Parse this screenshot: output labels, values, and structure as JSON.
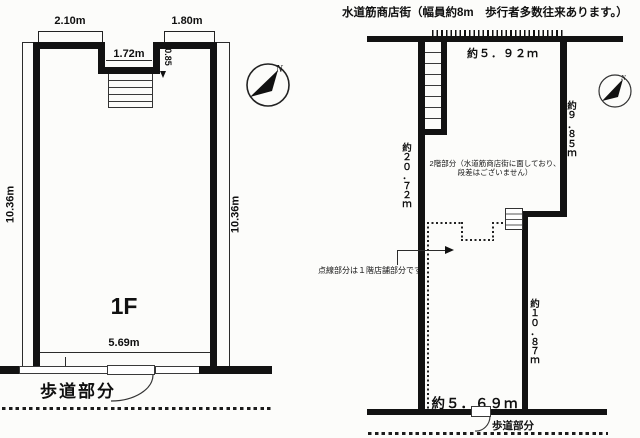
{
  "left_plan": {
    "dim_top_left": "2.10m",
    "dim_top_right": "1.80m",
    "dim_recess_width": "1.72m",
    "dim_recess_depth": "0.85",
    "dim_side_left": "10.36m",
    "dim_side_right": "10.36m",
    "dim_frontage": "5.69m",
    "floor_label": "1F",
    "sidewalk_label": "歩道部分",
    "compass_n": "N"
  },
  "right_plan": {
    "street_title": "水道筋商店街（幅員約8m　歩行者多数往来あります。）",
    "dim_top": "約５．９２ｍ",
    "dim_right_upper": "約９．８５ｍ",
    "dim_left": "約２０．７２ｍ",
    "dim_right_lower": "約１０．８７ｍ",
    "dim_bottom": "約５．６９ｍ",
    "note_2f_line1": "2階部分（水道筋商店街に面しており、",
    "note_2f_line2": "段差はございません）",
    "note_dotted": "点線部分は１階店舗部分です。",
    "sidewalk_label": "歩道部分",
    "compass_n": "N"
  },
  "colors": {
    "ink": "#111111",
    "paper": "#fcfcfa"
  }
}
